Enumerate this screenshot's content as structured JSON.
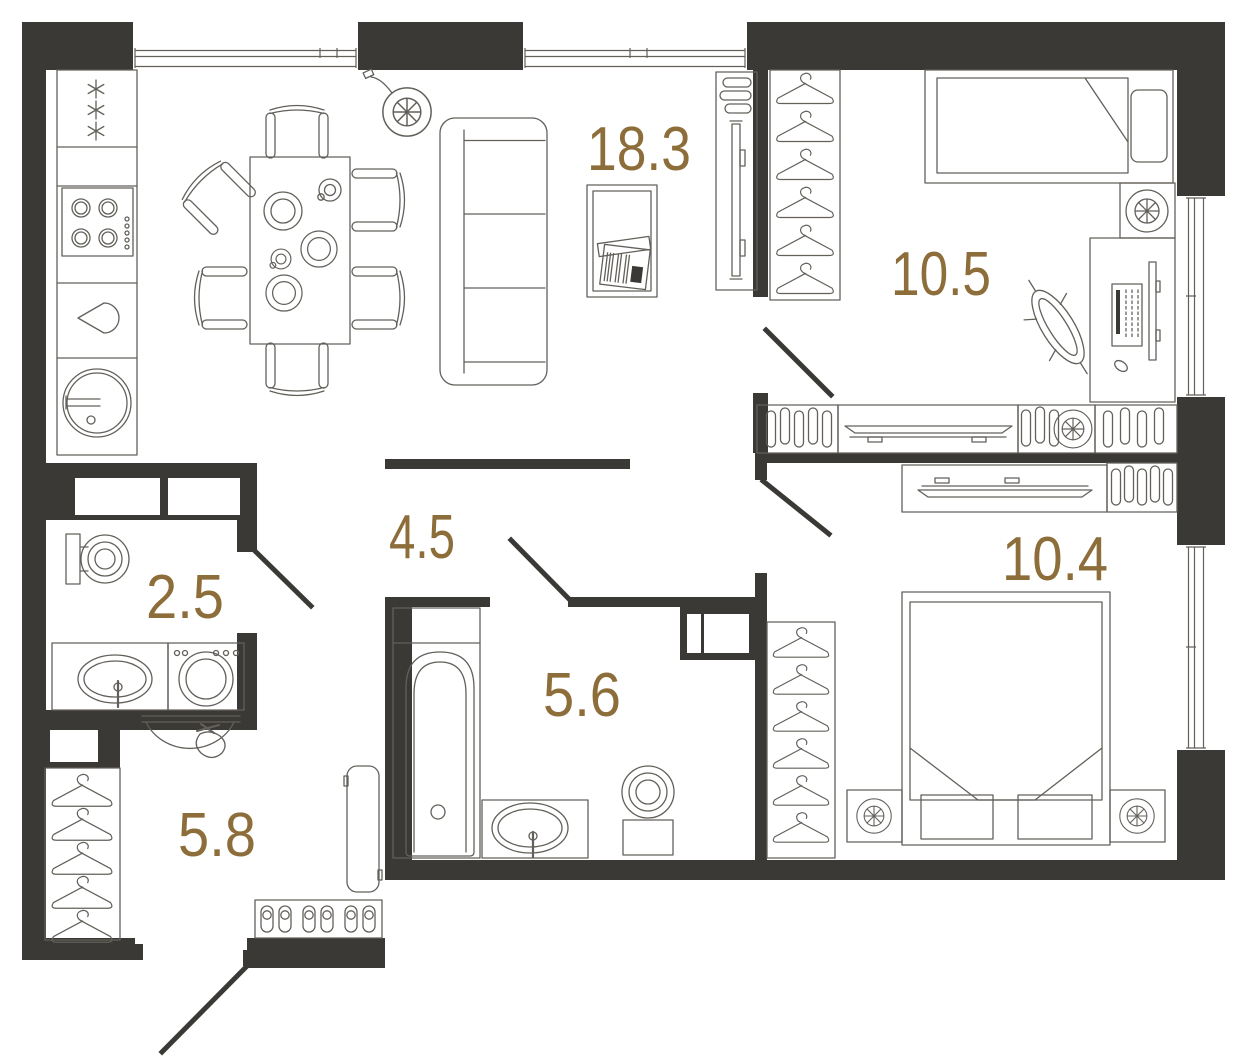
{
  "plan": {
    "room_labels": [
      {
        "id": "living-kitchen",
        "area": "18.3"
      },
      {
        "id": "bedroom-upper",
        "area": "10.5"
      },
      {
        "id": "bedroom-lower",
        "area": "10.4"
      },
      {
        "id": "hallway",
        "area": "4.5"
      },
      {
        "id": "wc",
        "area": "2.5"
      },
      {
        "id": "bathroom",
        "area": "5.6"
      },
      {
        "id": "entry-hall",
        "area": "5.8"
      }
    ],
    "colors": {
      "wall": "#3a3936",
      "furniture_line": "#63605a",
      "label": "#8d6e3a",
      "background": "#ffffff"
    }
  }
}
